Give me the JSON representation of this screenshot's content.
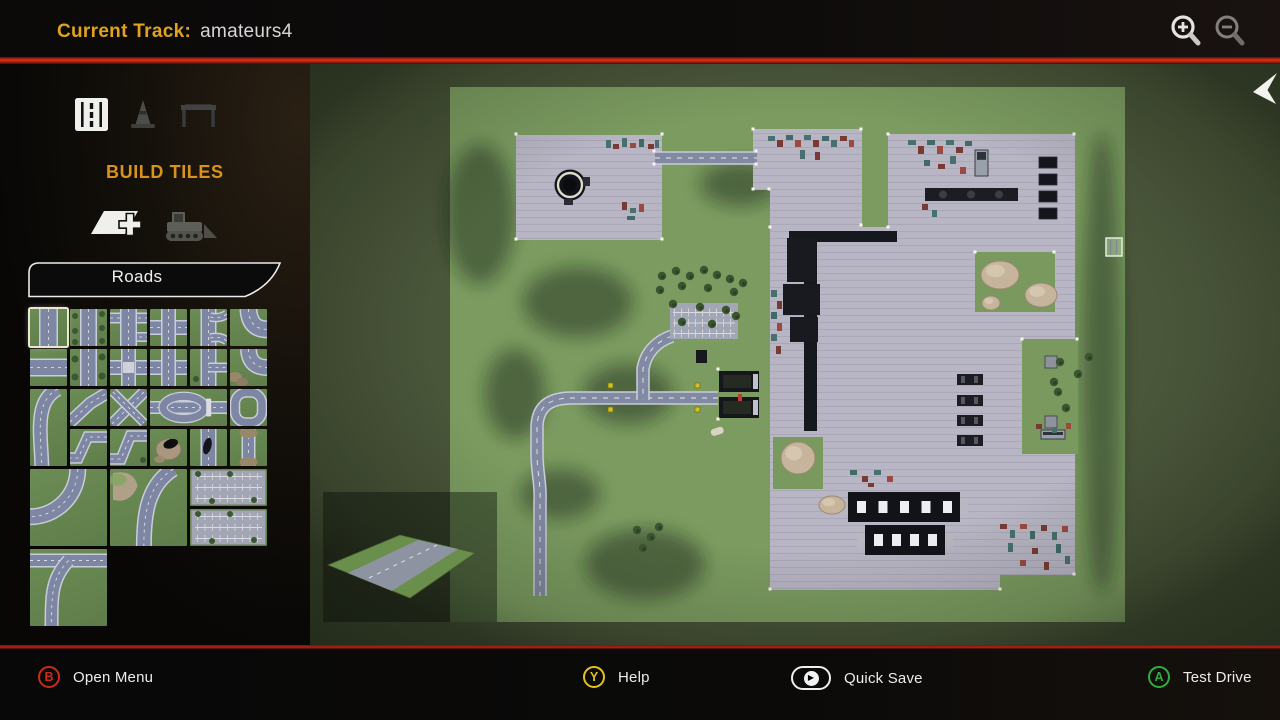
{
  "header": {
    "title_label": "Current Track:",
    "title_value": "amateurs4",
    "zoom_in_icon": "zoom-in-icon",
    "zoom_out_icon": "zoom-out-icon"
  },
  "pointer_icon": "mouse-cursor",
  "sidebar": {
    "section_title": "BUILD TILES",
    "category_label": "Roads",
    "mode_icons": [
      {
        "name": "road-tiles-icon",
        "active": true
      },
      {
        "name": "cone-props-icon",
        "active": false
      },
      {
        "name": "gate-props-icon",
        "active": false
      }
    ],
    "tool_icons": [
      {
        "name": "add-tile-icon",
        "active": true
      },
      {
        "name": "bulldozer-icon",
        "active": false
      }
    ],
    "tiles": [
      {
        "type": "straight-road",
        "col": 1,
        "row": 1,
        "selected": true
      },
      {
        "type": "straight-road-trees",
        "col": 2,
        "row": 1
      },
      {
        "type": "side-junctions",
        "col": 3,
        "row": 1
      },
      {
        "type": "crossroad",
        "col": 4,
        "row": 1
      },
      {
        "type": "double-curve",
        "col": 5,
        "row": 1
      },
      {
        "type": "curve",
        "col": 6,
        "row": 1
      },
      {
        "type": "straight-road-h",
        "col": 1,
        "row": 2
      },
      {
        "type": "straight-road-trees-2",
        "col": 2,
        "row": 2
      },
      {
        "type": "crossroad-crosswalk",
        "col": 3,
        "row": 2
      },
      {
        "type": "crossroad-2",
        "col": 4,
        "row": 2
      },
      {
        "type": "side-branch",
        "col": 5,
        "row": 2
      },
      {
        "type": "curve-dirt",
        "col": 6,
        "row": 2
      },
      {
        "type": "long-sweep",
        "col": 1,
        "row": 3,
        "rows": 2
      },
      {
        "type": "diagonal",
        "col": 2,
        "row": 3
      },
      {
        "type": "diagonal-cross",
        "col": 3,
        "row": 3
      },
      {
        "type": "oval-median",
        "col": 4,
        "row": 3,
        "cols": 2
      },
      {
        "type": "roundabout",
        "col": 6,
        "row": 3
      },
      {
        "type": "zigzag",
        "col": 2,
        "row": 4
      },
      {
        "type": "zigzag-2",
        "col": 3,
        "row": 4
      },
      {
        "type": "rock-cave",
        "col": 4,
        "row": 4
      },
      {
        "type": "road-blotch",
        "col": 5,
        "row": 4
      },
      {
        "type": "road-dirt",
        "col": 6,
        "row": 4
      },
      {
        "type": "large-curve",
        "col": 1,
        "row": 5,
        "cols": 2,
        "rows": 2
      },
      {
        "type": "large-curve-rock",
        "col": 3,
        "row": 5,
        "cols": 2,
        "rows": 2
      },
      {
        "type": "parking-lot",
        "col": 5,
        "row": 5,
        "cols": 2
      },
      {
        "type": "parking-lot-2",
        "col": 5,
        "row": 6,
        "cols": 2
      },
      {
        "type": "junction-curve",
        "col": 1,
        "row": 7,
        "cols": 2,
        "rows": 2
      }
    ]
  },
  "map": {
    "grass": [
      140,
      23,
      675,
      535
    ],
    "colors": {
      "oob": "#4c583c",
      "grass": "#7b9b60",
      "pavement": "#b8b5c4",
      "pav_line": "#aaa7b7",
      "road": "#8289a3",
      "road_edge": "#c9ccd9",
      "dark": "#15181d",
      "tree": "#3b5531",
      "rock": "#c6b59c",
      "mark_palette": [
        "#7a3a34",
        "#47706e",
        "#50608a",
        "#9a4a3e",
        "#3f6a68",
        "#8a8452"
      ]
    },
    "lots": [
      {
        "name": "northwest-lot",
        "rect": [
          206,
          71,
          146,
          105
        ]
      },
      {
        "name": "north-lot",
        "poly": "443,65 552,65 552,163 460,163 460,126 443,126"
      },
      {
        "name": "main-lot",
        "poly": "578,70 765,70 765,511 690,511 690,526 460,526 460,163 578,163"
      }
    ],
    "cutouts": [
      [
        665,
        188,
        80,
        60
      ],
      [
        712,
        275,
        56,
        115
      ],
      [
        463,
        373,
        50,
        52
      ]
    ],
    "shadows": [
      [
        170,
        150,
        35,
        70
      ],
      [
        268,
        238,
        55,
        35
      ],
      [
        318,
        330,
        45,
        30
      ],
      [
        335,
        500,
        60,
        35
      ],
      [
        250,
        430,
        40,
        25
      ],
      [
        792,
        300,
        20,
        230
      ],
      [
        430,
        120,
        40,
        22
      ],
      [
        205,
        330,
        30,
        45
      ]
    ],
    "roads": [
      "M345,94 H447",
      "M408,334 H262 C240,334 228,342 227,362 L227,390 C227,410 231,418 230,438 L230,532",
      "M362,272 C348,277 336,287 333,305 L333,336"
    ],
    "parking": {
      "rect": [
        360,
        239,
        68,
        36
      ]
    },
    "tank": {
      "cx": 260,
      "cy": 121
    },
    "crane": {
      "arm": [
        479,
        167,
        108,
        11
      ],
      "col": [
        494,
        167,
        13,
        200
      ],
      "blocks": [
        [
          477,
          174,
          29,
          44
        ],
        [
          473,
          220,
          37,
          31
        ],
        [
          480,
          253,
          28,
          25
        ]
      ]
    },
    "slabs": [
      [
        729,
        93
      ],
      [
        729,
        110
      ],
      [
        729,
        127
      ],
      [
        729,
        144
      ]
    ],
    "mach_row": [
      615,
      124,
      93,
      13
    ],
    "machines": [
      [
        647,
        310
      ],
      [
        647,
        331
      ],
      [
        647,
        351
      ],
      [
        647,
        371
      ]
    ],
    "cutout_machines": [
      [
        735,
        292,
        12,
        12
      ],
      [
        735,
        352,
        12,
        12
      ]
    ],
    "buildings": [
      {
        "rect": [
          538,
          428,
          112,
          30
        ],
        "windows": 5
      },
      {
        "rect": [
          555,
          461,
          80,
          30
        ],
        "windows": 4
      }
    ],
    "gate": {
      "trucks": [
        [
          409,
          307,
          40,
          21
        ],
        [
          409,
          333,
          40,
          21
        ]
      ],
      "figure": [
        428,
        330
      ]
    },
    "vehicles": [
      [
        665,
        86,
        13,
        26
      ],
      [
        731,
        366,
        24,
        9
      ]
    ],
    "marks": [
      [
        296,
        76,
        5,
        8,
        1
      ],
      [
        303,
        80,
        6,
        5,
        0
      ],
      [
        312,
        74,
        5,
        9,
        1
      ],
      [
        320,
        79,
        6,
        5,
        3
      ],
      [
        329,
        75,
        5,
        8,
        4
      ],
      [
        338,
        80,
        6,
        5,
        0
      ],
      [
        345,
        76,
        4,
        8,
        1
      ],
      [
        312,
        138,
        5,
        8,
        0
      ],
      [
        320,
        144,
        6,
        5,
        1
      ],
      [
        329,
        140,
        5,
        8,
        3
      ],
      [
        317,
        152,
        8,
        4,
        4
      ],
      [
        458,
        72,
        7,
        5,
        1
      ],
      [
        467,
        76,
        6,
        7,
        0
      ],
      [
        476,
        71,
        7,
        5,
        4
      ],
      [
        485,
        76,
        6,
        7,
        3
      ],
      [
        494,
        71,
        7,
        5,
        1
      ],
      [
        503,
        76,
        6,
        7,
        0
      ],
      [
        512,
        72,
        7,
        5,
        4
      ],
      [
        521,
        76,
        6,
        7,
        1
      ],
      [
        530,
        72,
        7,
        5,
        0
      ],
      [
        539,
        76,
        5,
        7,
        3
      ],
      [
        490,
        86,
        5,
        9,
        1
      ],
      [
        505,
        88,
        5,
        8,
        0
      ],
      [
        598,
        76,
        8,
        5,
        1
      ],
      [
        608,
        82,
        6,
        8,
        0
      ],
      [
        617,
        76,
        8,
        5,
        4
      ],
      [
        627,
        82,
        6,
        8,
        3
      ],
      [
        636,
        76,
        8,
        5,
        1
      ],
      [
        646,
        83,
        7,
        6,
        0
      ],
      [
        655,
        77,
        7,
        5,
        4
      ],
      [
        640,
        92,
        6,
        8,
        1
      ],
      [
        628,
        100,
        7,
        5,
        0
      ],
      [
        650,
        103,
        6,
        7,
        3
      ],
      [
        614,
        96,
        6,
        6,
        4
      ],
      [
        461,
        226,
        6,
        7,
        1
      ],
      [
        467,
        237,
        5,
        8,
        0
      ],
      [
        461,
        248,
        6,
        7,
        4
      ],
      [
        467,
        259,
        5,
        8,
        3
      ],
      [
        461,
        270,
        6,
        7,
        1
      ],
      [
        466,
        282,
        5,
        8,
        0
      ],
      [
        690,
        460,
        7,
        5,
        0
      ],
      [
        700,
        466,
        5,
        8,
        1
      ],
      [
        710,
        460,
        7,
        5,
        3
      ],
      [
        720,
        467,
        5,
        8,
        4
      ],
      [
        731,
        461,
        6,
        6,
        0
      ],
      [
        742,
        468,
        5,
        8,
        1
      ],
      [
        752,
        462,
        6,
        6,
        3
      ],
      [
        698,
        479,
        5,
        9,
        1
      ],
      [
        722,
        484,
        6,
        6,
        0
      ],
      [
        746,
        480,
        5,
        9,
        4
      ],
      [
        710,
        496,
        6,
        6,
        3
      ],
      [
        734,
        498,
        5,
        8,
        0
      ],
      [
        755,
        492,
        5,
        8,
        1
      ],
      [
        726,
        360,
        6,
        5,
        0
      ],
      [
        742,
        363,
        5,
        6,
        1
      ],
      [
        756,
        359,
        5,
        6,
        3
      ],
      [
        540,
        406,
        7,
        5,
        4
      ],
      [
        552,
        412,
        6,
        6,
        0
      ],
      [
        564,
        406,
        7,
        5,
        1
      ],
      [
        577,
        412,
        6,
        6,
        3
      ],
      [
        558,
        419,
        6,
        4,
        0
      ],
      [
        612,
        140,
        6,
        6,
        0
      ],
      [
        622,
        146,
        5,
        7,
        1
      ]
    ],
    "rocks": [
      [
        690,
        211,
        19,
        14
      ],
      [
        731,
        231,
        16,
        12
      ],
      [
        681,
        239,
        9,
        7
      ],
      [
        488,
        394,
        17,
        16
      ],
      [
        522,
        441,
        13,
        9
      ]
    ],
    "stones": [
      [
        400,
        366,
        13,
        7
      ]
    ],
    "trees": [
      [
        352,
        212
      ],
      [
        366,
        207
      ],
      [
        380,
        212
      ],
      [
        394,
        206
      ],
      [
        407,
        211
      ],
      [
        420,
        215
      ],
      [
        433,
        219
      ],
      [
        350,
        226
      ],
      [
        372,
        222
      ],
      [
        398,
        224
      ],
      [
        424,
        228
      ],
      [
        363,
        240
      ],
      [
        390,
        243
      ],
      [
        416,
        246
      ],
      [
        372,
        258
      ],
      [
        402,
        260
      ],
      [
        426,
        252
      ],
      [
        327,
        466
      ],
      [
        341,
        473
      ],
      [
        333,
        484
      ],
      [
        349,
        463
      ],
      [
        779,
        293
      ],
      [
        768,
        310
      ],
      [
        748,
        328
      ],
      [
        756,
        344
      ],
      [
        744,
        318
      ],
      [
        750,
        298
      ]
    ],
    "yellow_markers": [
      [
        298,
        319
      ],
      [
        385,
        319
      ],
      [
        298,
        343
      ],
      [
        385,
        343
      ]
    ],
    "dark_box": [
      386,
      286,
      11,
      13
    ],
    "corner_dots": [
      [
        206,
        70
      ],
      [
        352,
        70
      ],
      [
        206,
        175
      ],
      [
        352,
        175
      ],
      [
        443,
        65
      ],
      [
        551,
        65
      ],
      [
        551,
        161
      ],
      [
        443,
        125
      ],
      [
        459,
        125
      ],
      [
        578,
        70
      ],
      [
        764,
        70
      ],
      [
        578,
        163
      ],
      [
        460,
        163
      ],
      [
        460,
        525
      ],
      [
        690,
        525
      ],
      [
        764,
        510
      ],
      [
        665,
        188
      ],
      [
        744,
        188
      ],
      [
        712,
        275
      ],
      [
        767,
        275
      ],
      [
        344,
        87
      ],
      [
        344,
        100
      ],
      [
        446,
        87
      ],
      [
        446,
        100
      ],
      [
        408,
        305
      ],
      [
        408,
        355
      ]
    ],
    "cursor": [
      796,
      174,
      16,
      18
    ],
    "preview": {
      "rect": [
        13,
        428,
        174,
        130
      ],
      "diamond": "18,501 90,471 165,489 100,534",
      "road": "38,509 108,476 148,485 82,527",
      "centerline": "M59,514 L127,481"
    }
  },
  "footer": {
    "buttons": [
      {
        "key": "B",
        "shape": "circle",
        "label": "Open Menu",
        "color": "#cf2b16",
        "x": 38
      },
      {
        "key": "Y",
        "shape": "circle",
        "label": "Help",
        "color": "#e3c31f",
        "x": 583
      },
      {
        "key": "play",
        "shape": "stadium",
        "label": "Quick Save",
        "color": "#f0f0f0",
        "x": 791
      },
      {
        "key": "A",
        "shape": "circle",
        "label": "Test Drive",
        "color": "#2fae3e",
        "x": 1148
      }
    ]
  }
}
